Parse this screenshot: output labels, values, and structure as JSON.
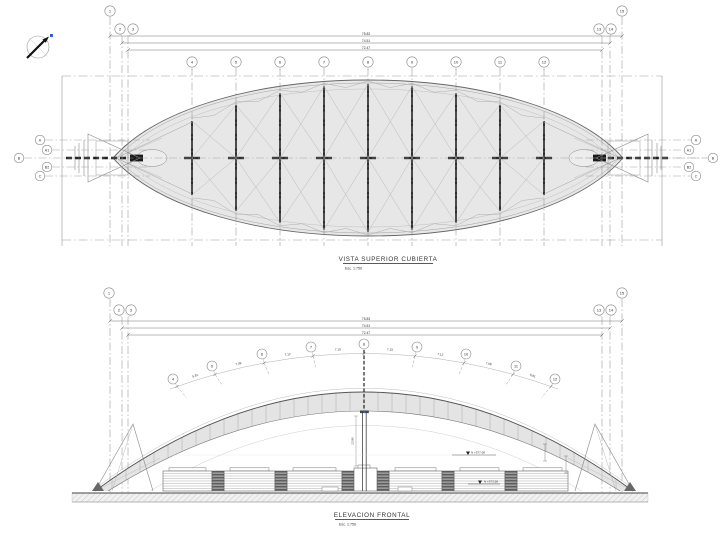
{
  "plan": {
    "title": "VISTA SUPERIOR CUBIERTA",
    "scale_label": "Esc. 1:750",
    "overall_dims": [
      "75.83",
      "74.51",
      "72.47"
    ],
    "grid_left": [
      "1",
      "2",
      "3"
    ],
    "grid_right": [
      "13",
      "14",
      "15"
    ],
    "grid_mid": [
      "4",
      "5",
      "6",
      "7",
      "8",
      "9",
      "10",
      "11",
      "12"
    ],
    "axis_labels": [
      "A",
      "A1",
      "B",
      "B2",
      "C"
    ]
  },
  "elevation": {
    "title": "ELEVACION FRONTAL",
    "scale_label": "Esc. 1:750",
    "overall_dims": [
      "75.83",
      "74.51",
      "72.47"
    ],
    "grid_left": [
      "1",
      "2",
      "3"
    ],
    "grid_right": [
      "13",
      "14",
      "15"
    ],
    "arc_grid": [
      "4",
      "5",
      "6",
      "7",
      "8",
      "9",
      "10",
      "11",
      "12"
    ],
    "arc_dims": [
      "5.81",
      "7.08",
      "7.12",
      "7.15",
      "7.15",
      "7.12",
      "7.08",
      "5.81"
    ],
    "column_dim": "12.80",
    "levels": [
      "N +577.08",
      "N +573.58"
    ]
  },
  "colors": {
    "line": "#555555",
    "roof_fill": "#e7e7e7",
    "accent_blue": "#3a5fcd"
  }
}
